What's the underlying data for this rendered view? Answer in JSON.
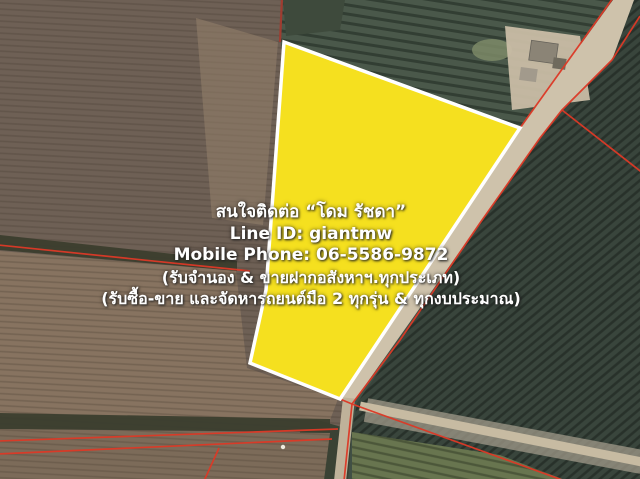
{
  "contact_overlay": {
    "line1": "สนใจติดต่อ “โดม รัชดา”",
    "line2": "Line ID: giantmw",
    "line3": "Mobile Phone: 06-5586-9872",
    "line4": "(รับจำนอง & ขายฝากอสังหาฯ.ทุกประเภท)",
    "line5": "(รับซื้อ-ขาย และจัดหารถยนต์มือ 2 ทุกรุ่น & ทุกงบประมาณ)"
  },
  "colors": {
    "plot_highlight_fill": "#F5E01F",
    "plot_highlight_border": "#FFFFFF",
    "parcel_boundary_red": "#DC3927",
    "overlay_text": "#FFFFFF"
  }
}
